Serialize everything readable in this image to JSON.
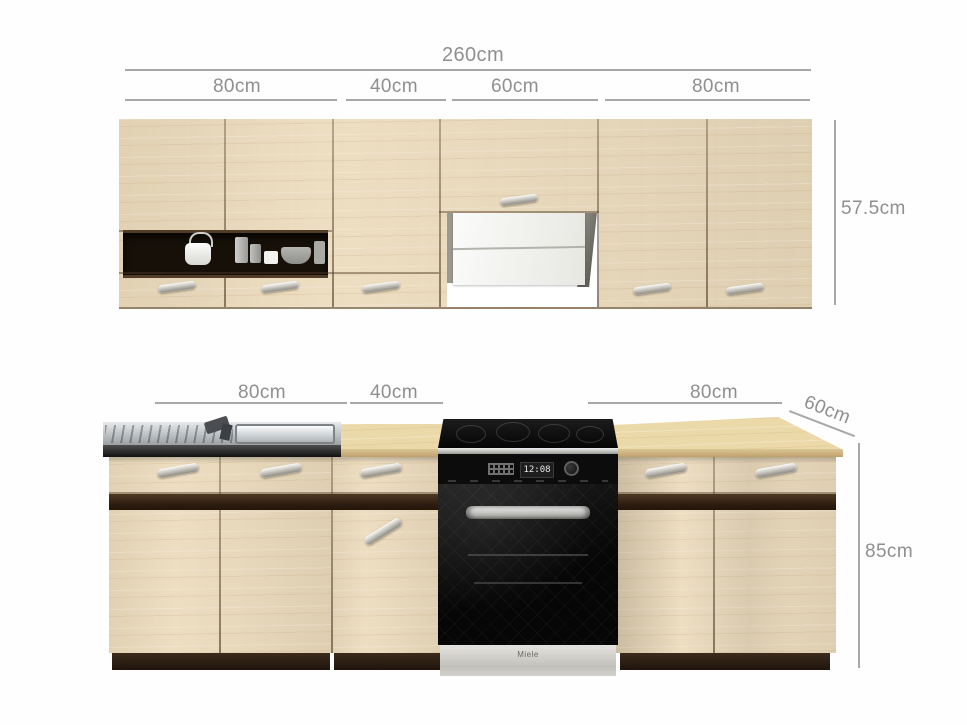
{
  "diagram": {
    "upper": {
      "total": "260cm",
      "segments": [
        "80cm",
        "40cm",
        "60cm",
        "80cm"
      ],
      "height": "57.5cm"
    },
    "lower": {
      "segments": [
        "80cm",
        "40cm",
        "80cm"
      ],
      "depth": "60cm",
      "height": "85cm"
    }
  },
  "appliances": {
    "oven": {
      "brand": "Miele",
      "clock": "12:08"
    }
  },
  "colors": {
    "background": "#fefefe",
    "wood_cabinet": "#ebdabb",
    "wood_counter": "#ecd9a9",
    "wenge_accent": "#2f2013",
    "dimension_text": "#8f8f8f",
    "dimension_line": "#a8a8a8",
    "steel": "#b9bdc1",
    "oven_black": "#0d0d0d",
    "hood_white": "#f4f4f2"
  }
}
